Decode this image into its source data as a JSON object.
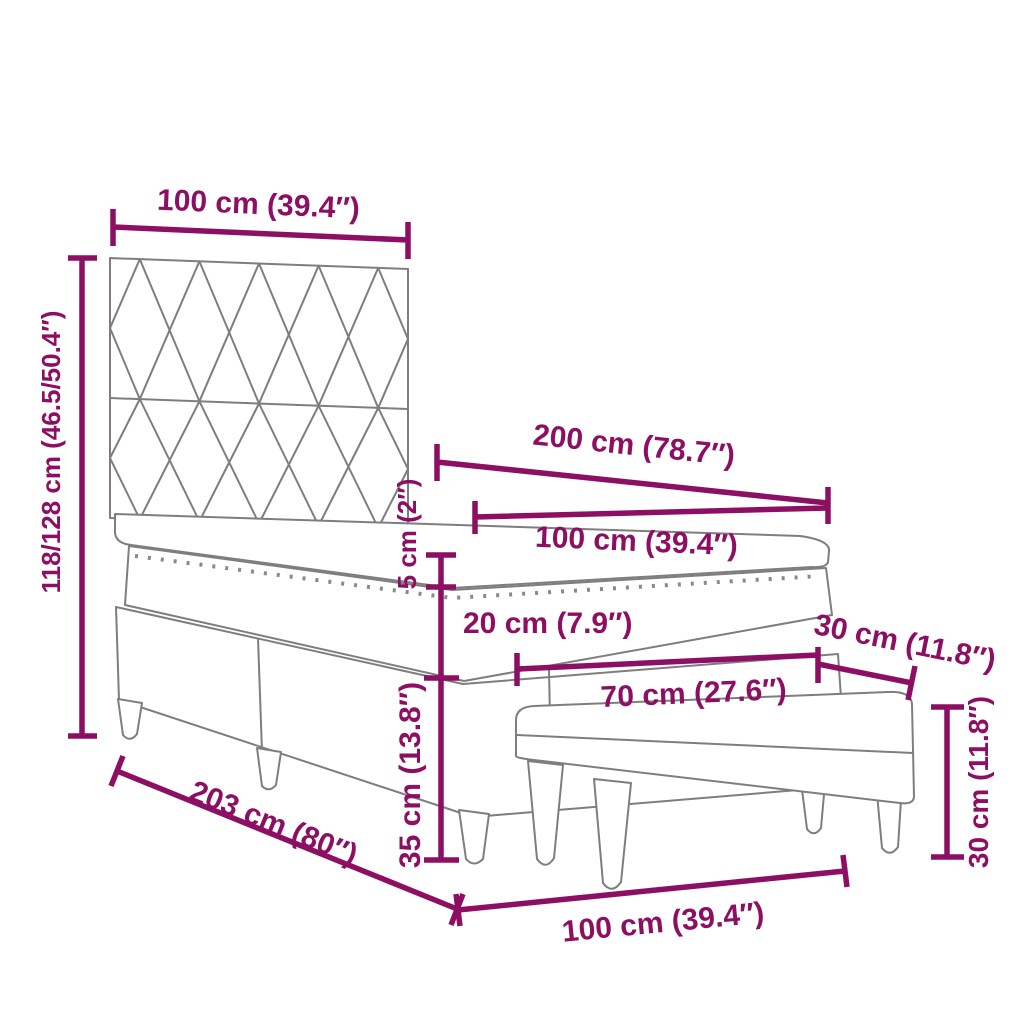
{
  "accent_color": "#8d0f63",
  "outline_color": "#7e7e7e",
  "diagram": {
    "subject": "box-spring-bed-with-headboard-and-bench-dimension-diagram",
    "labels": {
      "headboard_width": "100 cm (39.4″)",
      "bed_height": "118/128 cm (46.5/50.4″)",
      "bed_length_top": "200 cm (78.7″)",
      "mattress_width": "100 cm (39.4″)",
      "topper_height": "5 cm (2″)",
      "mattress_height": "20 cm (7.9″)",
      "base_height": "35 cm (13.8″)",
      "bench_width": "70 cm (27.6″)",
      "bench_depth": "30 cm (11.8″)",
      "bench_height": "30 cm (11.8″)",
      "bed_total_length": "203 cm (80″)",
      "bed_width_bottom": "100 cm (39.4″)"
    }
  }
}
